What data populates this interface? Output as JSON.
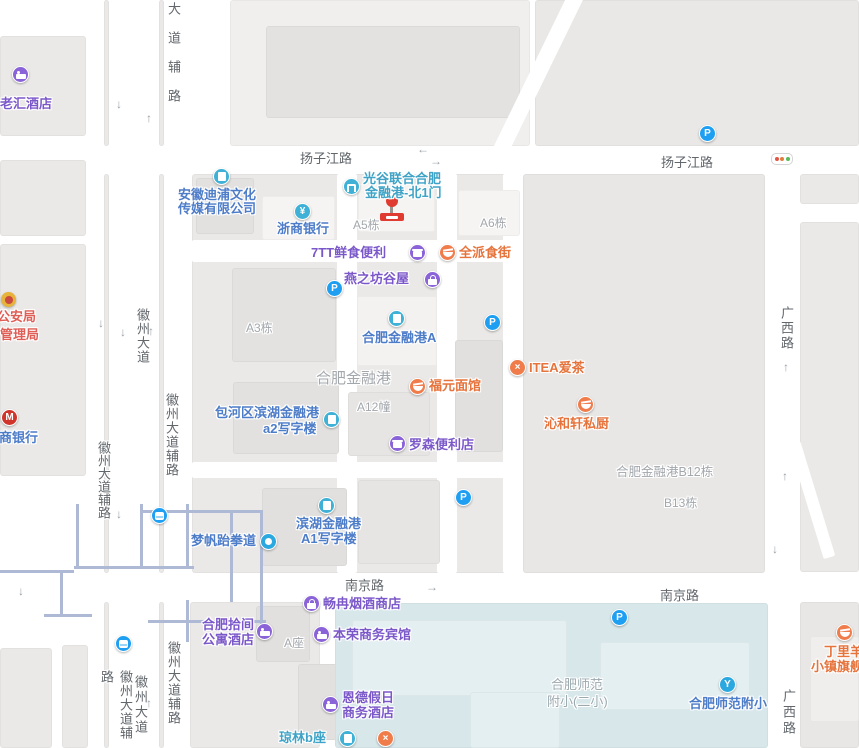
{
  "colors": {
    "poi_purple": "#7B58C9",
    "poi_blue": "#4D7CC8",
    "poi_teal": "#3EA3C6",
    "poi_orange": "#E6733B",
    "poi_red": "#DF5E56",
    "icon_purple": "#8A63D8",
    "icon_teal": "#3FB0D6",
    "icon_orange": "#EF7C4A",
    "icon_blue": "#2BA8E0",
    "parking_blue": "#1E9FF2",
    "marker_red": "#E03B30",
    "campus_blue": "#D7E7EA",
    "road_label_gray": "#62676C",
    "area_label_gray": "#A2A7AC"
  },
  "glyphs": {
    "parking": "P",
    "bank": "¥",
    "cmb_m": "M",
    "cross": "×",
    "school": "Y",
    "arrow_up": "↑",
    "arrow_down": "↓",
    "arrow_left": "←",
    "arrow_right": "→"
  },
  "road_labels": {
    "fulu_top": "大道辅路",
    "yangzijiang_w": "扬子江路",
    "yangzijiang_e": "扬子江路",
    "huizhou_mid": "徽州大道",
    "huizhou_fulu_w": "徽州大道辅路",
    "huizhou_fulu_e": "徽州大道辅路",
    "nanjing_w": "南京路",
    "nanjing_e": "南京路",
    "guangxi_mid": "广西路",
    "guangxi_s": "广西路",
    "huizhou_fulu_sw": "徽州大道辅路",
    "huizhou_s": "徽州大道",
    "huizhou_fulu_se": "徽州大道辅路"
  },
  "area_labels": {
    "a5": "A5栋",
    "a6": "A6栋",
    "a3": "A3栋",
    "jrg": "合肥金融港",
    "a12": "A12幢",
    "b12": "合肥金融港B12栋",
    "b13": "B13栋",
    "azuo": "A座",
    "shifan1": "合肥师范",
    "shifan2": "附小(二小)"
  },
  "pois": {
    "laohui": {
      "name": "老汇酒店"
    },
    "gongan": {
      "line1": "市公安局",
      "line2": "管理局"
    },
    "zhaoshang": {
      "name": "招商银行"
    },
    "dipu": {
      "line1": "安徽迪浦文化",
      "line2": "传媒有限公司"
    },
    "zheshang": {
      "name": "浙商银行"
    },
    "guanggu": {
      "line1": "光谷联合合肥",
      "line2": "金融港-北1门"
    },
    "qtt": {
      "name": "7TT鲜食便利"
    },
    "quanpai": {
      "name": "全派食街"
    },
    "yanzhifang": {
      "name": "燕之坊谷屋"
    },
    "jrga": {
      "name": "合肥金融港A"
    },
    "fuyuan": {
      "name": "福元面馆"
    },
    "itea": {
      "name": "ITEA爱茶"
    },
    "qinhexuan": {
      "name": "沁和轩私厨"
    },
    "a2": {
      "line1": "包河区滨湖金融港",
      "line2": "a2写字楼"
    },
    "lawson": {
      "name": "罗森便利店"
    },
    "a1": {
      "line1": "滨湖金融港",
      "line2": "A1写字楼"
    },
    "mengfan": {
      "name": "梦帆跆拳道"
    },
    "changran": {
      "name": "畅冉烟酒商店"
    },
    "shijian": {
      "line1": "合肥拾间",
      "line2": "公寓酒店"
    },
    "benrong": {
      "name": "本荣商务宾馆"
    },
    "ende": {
      "line1": "恩德假日",
      "line2": "商务酒店"
    },
    "qionglin": {
      "name": "琼林b座"
    },
    "fuxiao": {
      "name": "合肥师范附小"
    },
    "dingliyang": {
      "line1": "丁里羊",
      "line2": "小镇旗舰店"
    }
  }
}
